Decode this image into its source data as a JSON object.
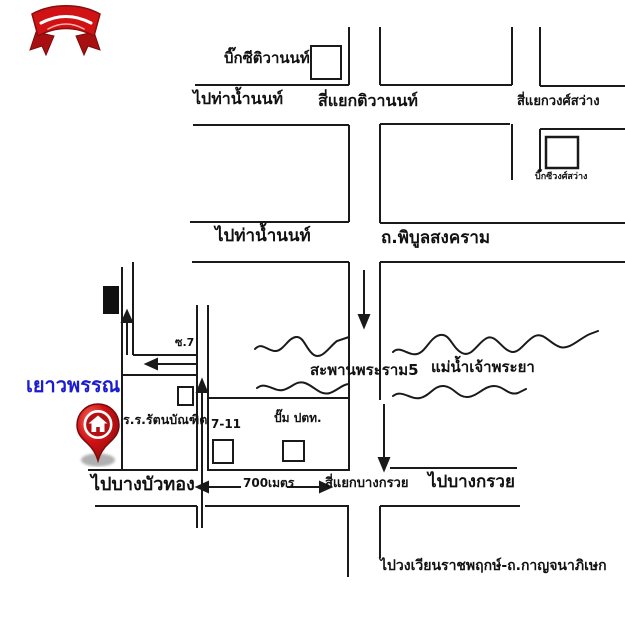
{
  "map": {
    "labels": {
      "big_c_tiwanon": "บิ๊กซีติวานนท์",
      "to_tha_nam_non_top": "ไปท่าน้ำนนท์",
      "tiwanon_intersection": "สี่แยกติวานนท์",
      "wongsawang_intersection": "สี่แยกวงศ์สว่าง",
      "big_c_wongsawang": "บิ๊กซีวงศ์สว่าง",
      "to_tha_nam_non_mid": "ไปท่าน้ำนนท์",
      "phibun_songkhram_rd": "ถ.พิบูลสงคราม",
      "soi_7": "ซ.7",
      "rama5_bridge": "สะพานพระราม5",
      "chao_phraya_river": "แม่น้ำเจ้าพระยา",
      "destination_name": "เยาวพรรณ",
      "school": "ร.ร.รัตนบัณฑิต",
      "seven_eleven": "7-11",
      "ptt_station": "ปั๊ม ปตท.",
      "to_bang_bua_thong": "ไปบางบัวทอง",
      "distance": "700เมตร",
      "bang_kruai_intersection": "สี่แยกบางกรวย",
      "to_bang_kruai": "ไปบางกรวย",
      "to_ratchaphruek_kanchanaphisek": "ไปวงเวียนราชพฤกษ์-ถ.กาญจนาภิเษก"
    },
    "colors": {
      "map_line": "#1a1a1a",
      "destination_text": "#1b1bd0",
      "pin_red": "#d01215",
      "pin_border": "#7c0a0c",
      "shadow_gray": "#a8a8a8"
    }
  }
}
